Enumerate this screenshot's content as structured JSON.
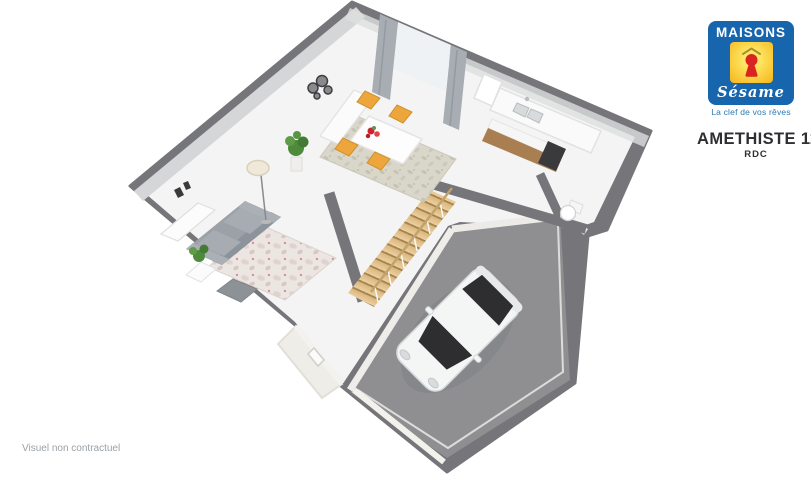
{
  "branding": {
    "brand_top": "MAISONS",
    "brand_bottom": "Sésame",
    "tagline": "La clef de vos rêves"
  },
  "plan_header": {
    "model": "AMETHISTE 110 GI",
    "level": "RDC"
  },
  "footer": {
    "disclaimer": "Visuel non contractuel"
  },
  "palette": {
    "wall_dark": "#76767a",
    "wall_light": "#d5d6d8",
    "floor_white": "#f4f4f5",
    "garage_floor": "#8f8f92",
    "stair_wood": "#d9b67f",
    "counter_wood": "#a97e50",
    "sofa_gray": "#9ba1a6",
    "chair_orange": "#eda63c",
    "rug_beige": "#d9d6ca",
    "rug_rose": "#ece6e2",
    "plant_green": "#4e8a3c",
    "car_white": "#f4f5f5",
    "glass_dark": "#2e2e31",
    "curtain_gray": "#a7adb2",
    "logo_blue": "#1766ad",
    "logo_yellow": "#f8c61f",
    "logo_red": "#d9251f",
    "text_dark": "#2f2f33",
    "text_gray": "#9aa1a7",
    "tagline_blue": "#2a79b5"
  }
}
